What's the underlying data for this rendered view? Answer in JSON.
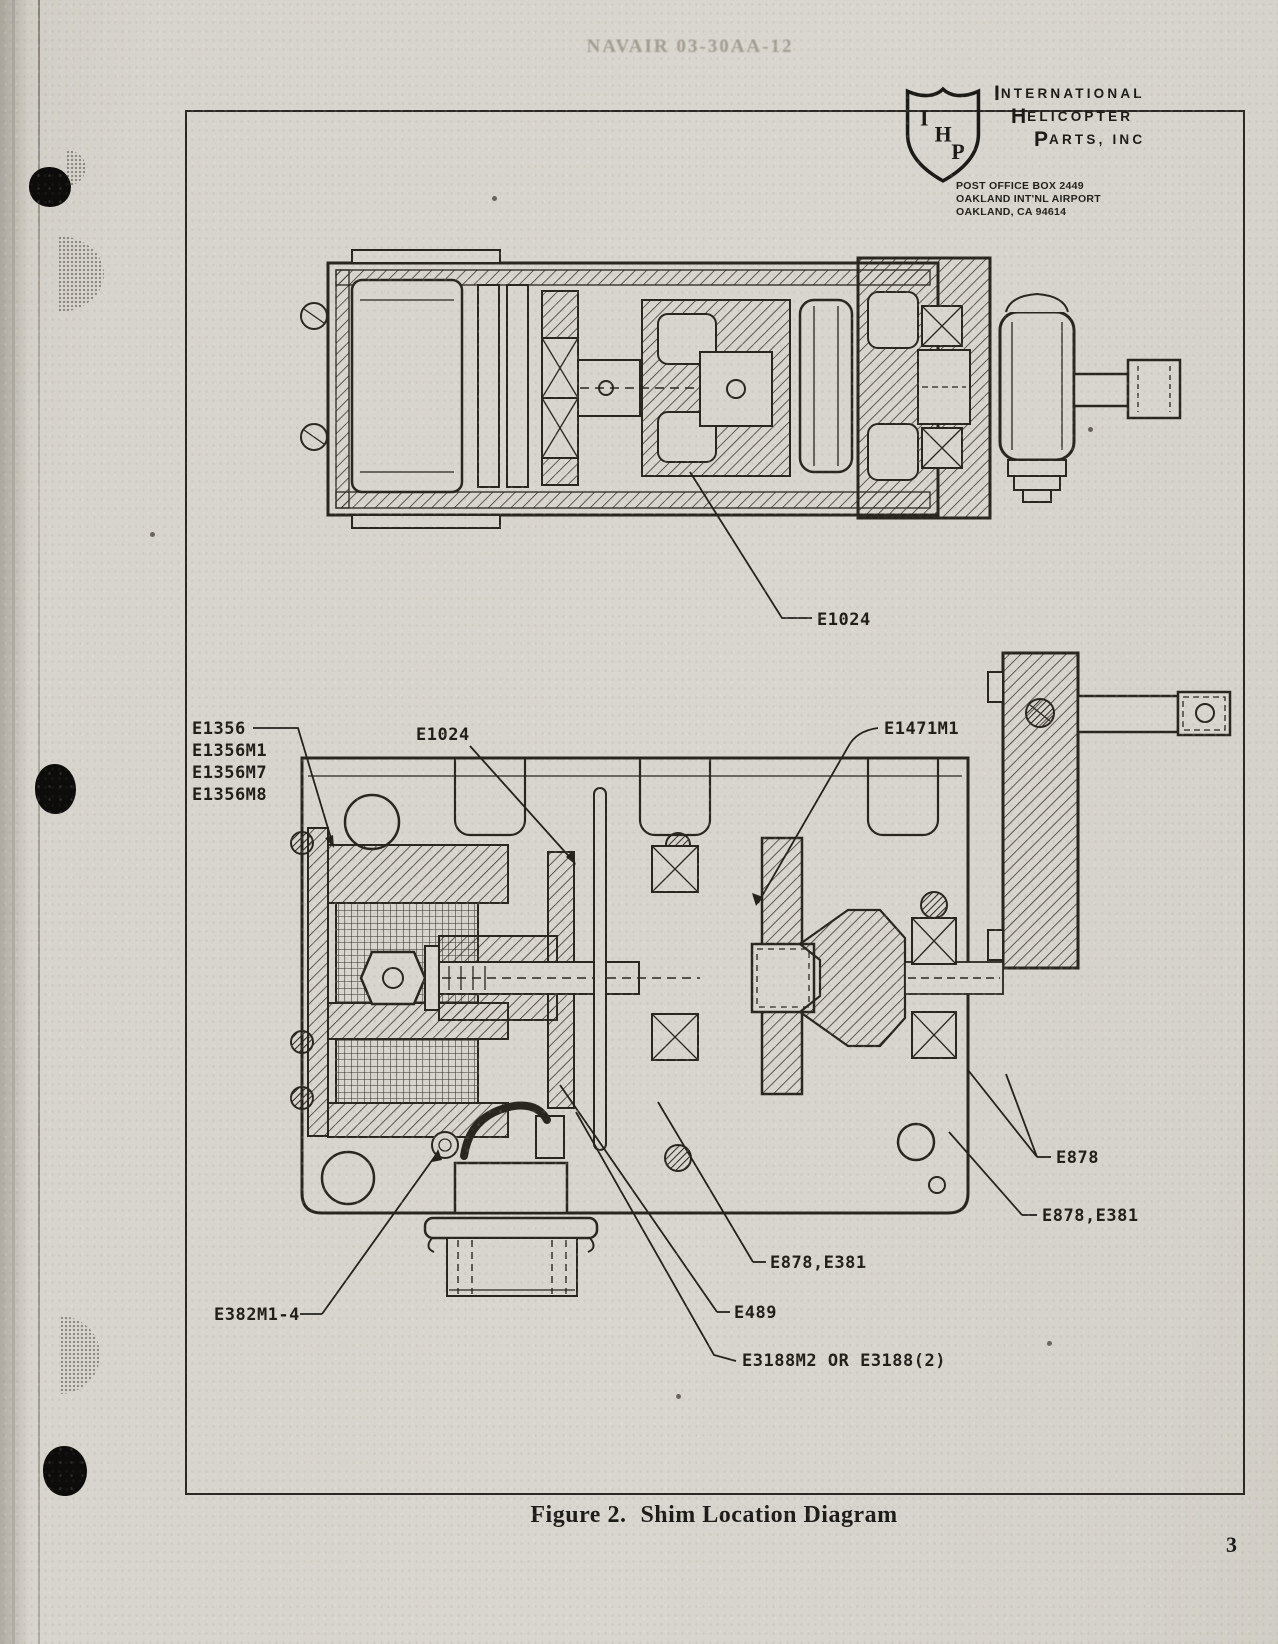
{
  "header": {
    "stamp": "NAVAIR 03-30AA-12"
  },
  "logo": {
    "shield_letters": [
      "I",
      "H",
      "P"
    ],
    "name_lines": [
      {
        "initial": "I",
        "rest": "NTERNATIONAL"
      },
      {
        "initial": "H",
        "rest": "ELICOPTER"
      },
      {
        "initial": "P",
        "rest": "ARTS, INC"
      }
    ],
    "address": [
      "POST OFFICE BOX 2449",
      "OAKLAND INT'NL AIRPORT",
      "OAKLAND, CA 94614"
    ]
  },
  "figure": {
    "label": "Figure 2.",
    "title": "Shim Location Diagram",
    "page_number": "3"
  },
  "part_labels": {
    "e1024_top": "E1024",
    "e1356_stack": [
      "E1356",
      "E1356M1",
      "E1356M7",
      "E1356M8"
    ],
    "e1024_mid": "E1024",
    "e1471m1": "E1471M1",
    "e878": "E878",
    "e878_e381_right": "E878,E381",
    "e878_e381_mid": "E878,E381",
    "e489": "E489",
    "e382m1_4": "E382M1-4",
    "e3188": "E3188M2 OR E3188(2)"
  }
}
